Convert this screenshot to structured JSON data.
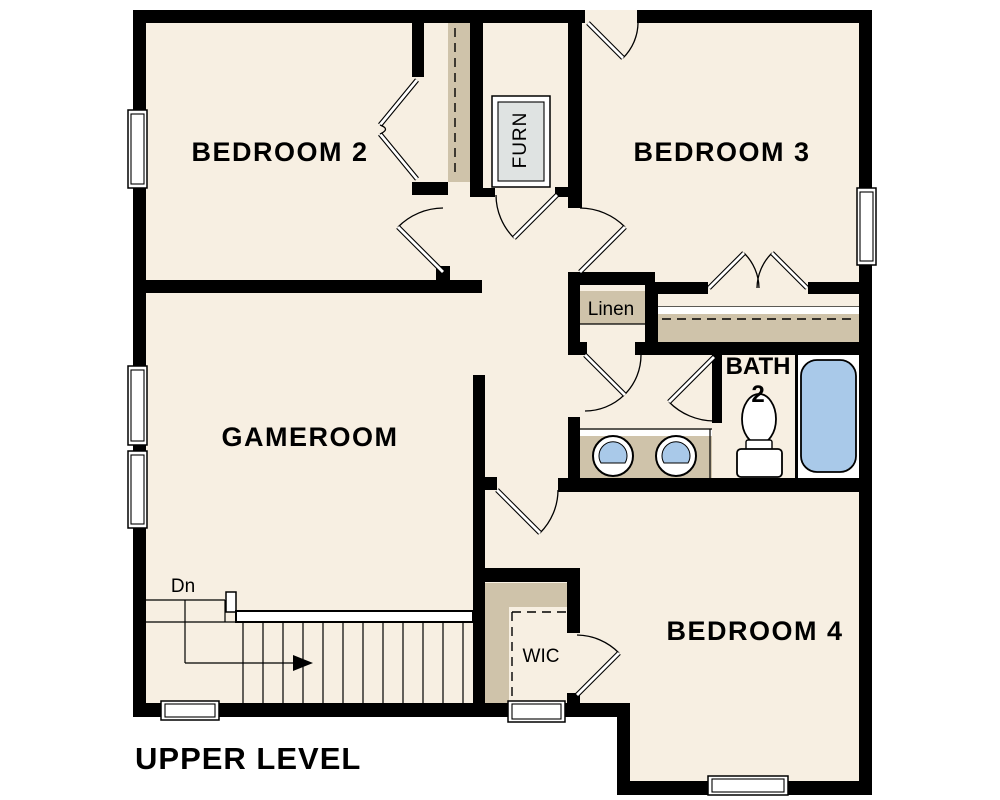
{
  "title": "UPPER LEVEL",
  "rooms": {
    "bedroom2": {
      "label": "BEDROOM 2"
    },
    "bedroom3": {
      "label": "BEDROOM 3"
    },
    "gameroom": {
      "label": "GAMEROOM"
    },
    "bedroom4": {
      "label": "BEDROOM 4"
    },
    "bath2": {
      "label_line1": "BATH",
      "label_line2": "2"
    },
    "linen": {
      "label": "Linen"
    },
    "wic": {
      "label": "WIC"
    },
    "furnace": {
      "label": "FURN"
    }
  },
  "stairs": {
    "direction_label": "Dn"
  },
  "fixtures": [
    "bathtub",
    "toilet",
    "sink",
    "sink",
    "furnace",
    "vanity-counter"
  ],
  "colors": {
    "floor": "#f7efe2",
    "wall": "#000000",
    "shelf_tan": "#cfc3aa",
    "fixture_blue": "#a9c9e9",
    "furnace_gray": "#dfe3e2",
    "outside": "#ffffff"
  }
}
